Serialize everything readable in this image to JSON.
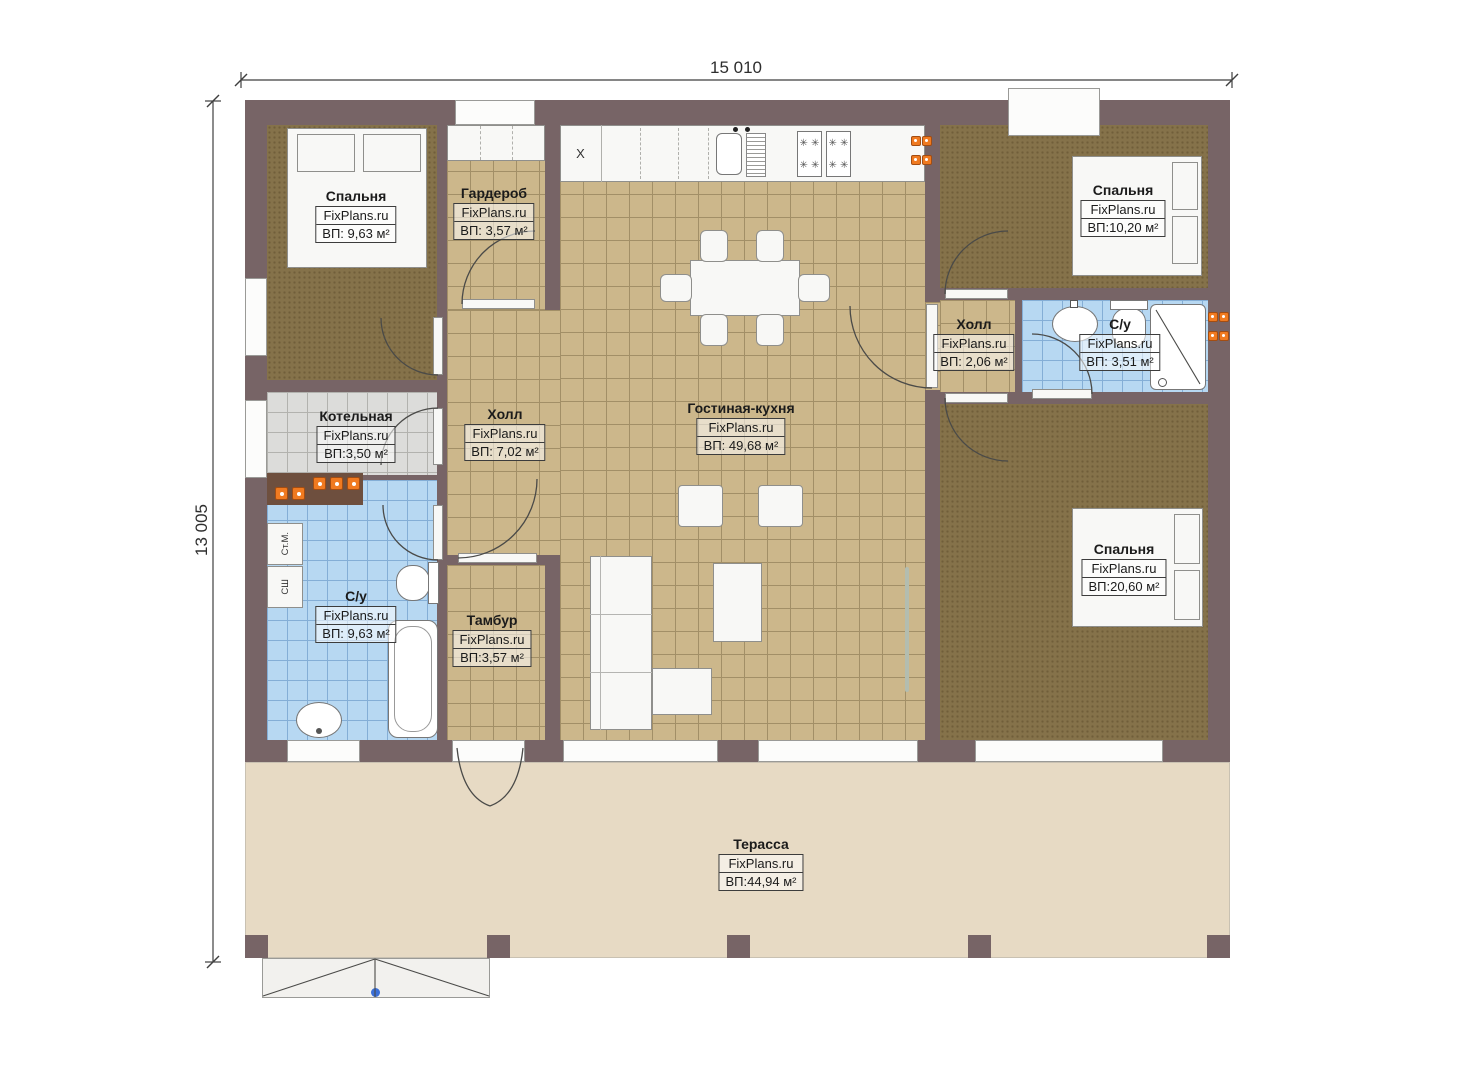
{
  "brand": "FixPlans.ru",
  "dimensions": {
    "width": "15 010",
    "height": "13 005"
  },
  "rooms": [
    {
      "key": "bedroom_tl",
      "name": "Спальня",
      "brand": "FixPlans.ru",
      "area": "ВП: 9,63 м²"
    },
    {
      "key": "wardrobe",
      "name": "Гардероб",
      "brand": "FixPlans.ru",
      "area": "ВП: 3,57 м²"
    },
    {
      "key": "bedroom_tr",
      "name": "Спальня",
      "brand": "FixPlans.ru",
      "area": "ВП:10,20 м²"
    },
    {
      "key": "hall_right",
      "name": "Холл",
      "brand": "FixPlans.ru",
      "area": "ВП: 2,06 м²"
    },
    {
      "key": "bathroom_right",
      "name": "С/у",
      "brand": "FixPlans.ru",
      "area": "ВП: 3,51 м²"
    },
    {
      "key": "boiler_room",
      "name": "Котельная",
      "brand": "FixPlans.ru",
      "area": "ВП:3,50 м²"
    },
    {
      "key": "hall_center",
      "name": "Холл",
      "brand": "FixPlans.ru",
      "area": "ВП: 7,02 м²"
    },
    {
      "key": "living_kitchen",
      "name": "Гостиная-кухня",
      "brand": "FixPlans.ru",
      "area": "ВП: 49,68 м²"
    },
    {
      "key": "bedroom_br",
      "name": "Спальня",
      "brand": "FixPlans.ru",
      "area": "ВП:20,60 м²"
    },
    {
      "key": "bathroom_left",
      "name": "С/у",
      "brand": "FixPlans.ru",
      "area": "ВП: 9,63 м²"
    },
    {
      "key": "vestibule",
      "name": "Тамбур",
      "brand": "FixPlans.ru",
      "area": "ВП:3,57 м²"
    },
    {
      "key": "terrace",
      "name": "Терасса",
      "brand": "FixPlans.ru",
      "area": "ВП:44,94 м²"
    }
  ],
  "appliances": {
    "washer": "Ст.М.",
    "dryer": "СШ",
    "fridge": "X"
  },
  "icons": {
    "burner": "✳"
  },
  "colors": {
    "wall": "#776466",
    "bedroom_floor": "#85724a",
    "tile_tan": "#ccb78b",
    "tile_blue": "#b7d8f2",
    "tile_gray": "#dcdcda",
    "terrace": "#e7dac4",
    "radiator": "#f07a20",
    "step_marker": "#3a6fd8"
  }
}
